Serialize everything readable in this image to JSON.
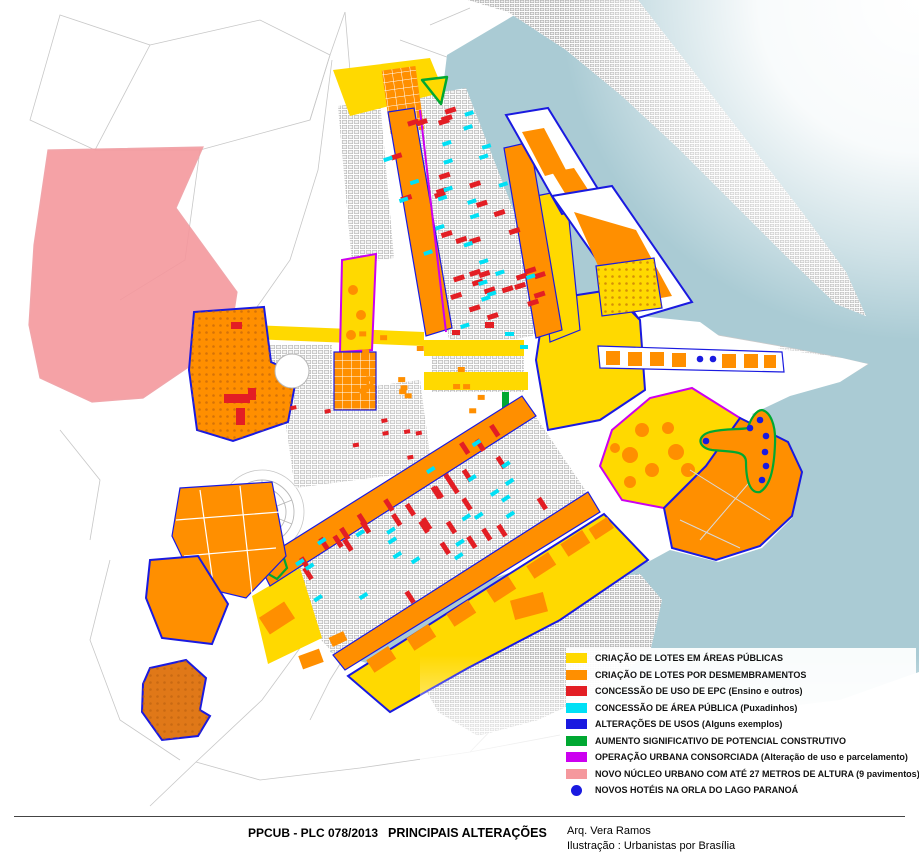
{
  "legend": {
    "items": [
      {
        "id": "lotes-areas-publicas",
        "label": "CRIAÇÃO DE LOTES EM ÁREAS PÚBLICAS",
        "color": "#FFD900",
        "shape": "square"
      },
      {
        "id": "lotes-desmembramentos",
        "label": "CRIAÇÃO DE LOTES POR DESMEMBRAMENTOS",
        "color": "#FF8F00",
        "shape": "square"
      },
      {
        "id": "concessao-uso-epc",
        "label": "CONCESSÃO DE USO DE EPC (Ensino e outros)",
        "color": "#E31E24",
        "shape": "square"
      },
      {
        "id": "concessao-area-publica",
        "label": "CONCESSÃO DE ÁREA PÚBLICA (Puxadinhos)",
        "color": "#00E0F5",
        "shape": "square"
      },
      {
        "id": "alteracoes-usos",
        "label": "ALTERAÇÕES DE USOS (Alguns exemplos)",
        "color": "#1A1AE0",
        "shape": "square"
      },
      {
        "id": "aumento-potencial",
        "label": "AUMENTO SIGNIFICATIVO DE POTENCIAL CONSTRUTIVO",
        "color": "#00A832",
        "shape": "square"
      },
      {
        "id": "operacao-urbana",
        "label": "OPERAÇÃO URBANA CONSORCIADA (Alteração de uso e parcelamento)",
        "color": "#CC00F0",
        "shape": "square"
      },
      {
        "id": "novo-nucleo-urbano",
        "label": "NOVO NÚCLEO URBANO COM ATÉ 27 METROS DE ALTURA (9 pavimentos)",
        "color": "#F5989D",
        "shape": "square"
      },
      {
        "id": "novos-hoteis",
        "label": "NOVOS HOTÉIS NA ORLA DO LAGO PARANOÁ",
        "color": "#1A1AE0",
        "shape": "dot"
      }
    ]
  },
  "footer": {
    "document": "PPCUB - PLC 078/2013",
    "title": "PRINCIPAIS ALTERAÇÕES",
    "author": "Arq. Vera Ramos",
    "illustration": "Ilustração : Urbanistas por Brasília"
  },
  "map": {
    "colors": {
      "c-yellow": "#FFD900",
      "c-orange": "#FF8F00",
      "c-red": "#E31E24",
      "c-cyan": "#00E0F5",
      "c-blue": "#1A1AE0",
      "c-green": "#00A832",
      "c-magenta": "#CC00F0",
      "c-pink": "#F5989D",
      "c-lake": "#AACBD4"
    }
  }
}
